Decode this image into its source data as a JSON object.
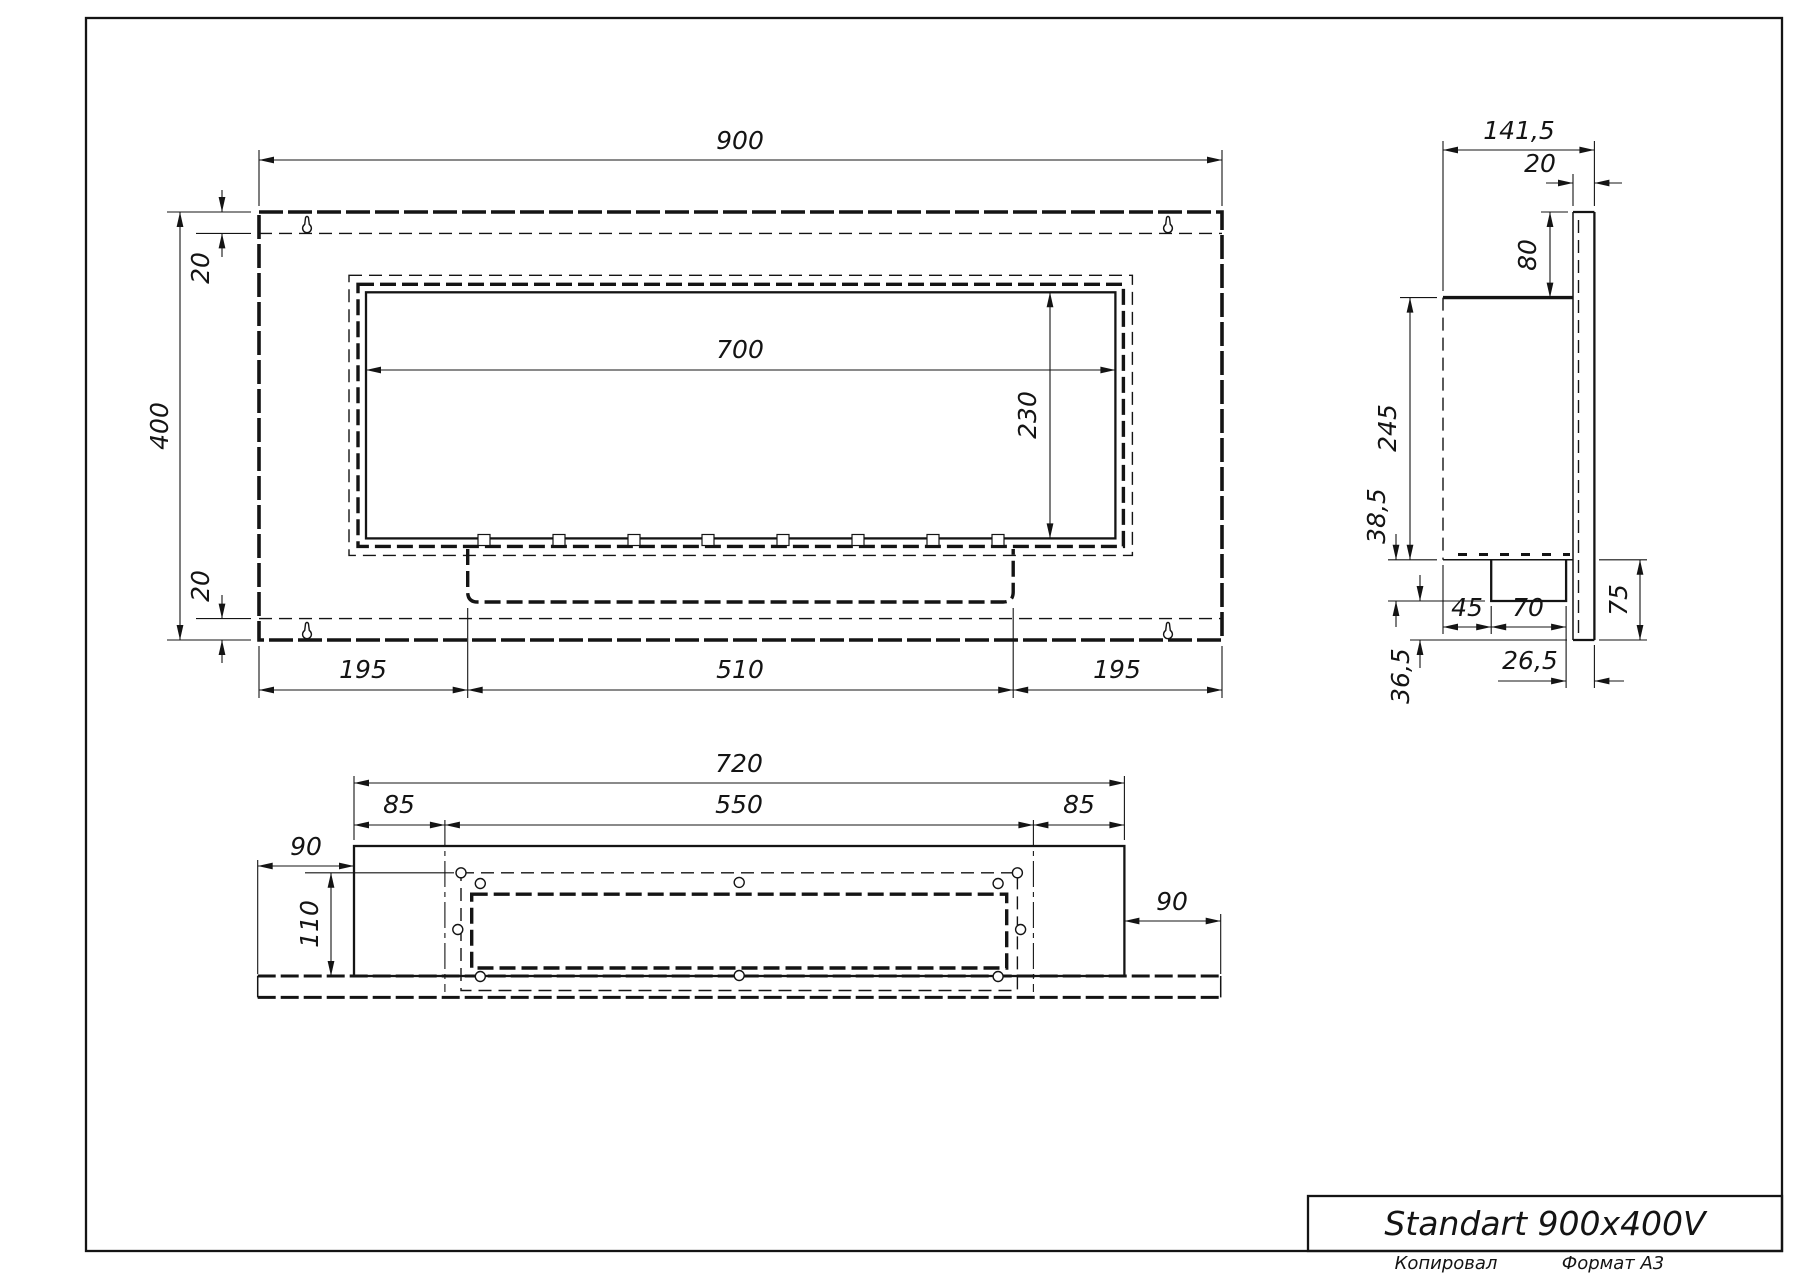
{
  "front_view": {
    "width": "900",
    "height": "400",
    "top_offset": "20",
    "bottom_offset": "20",
    "opening_width": "700",
    "opening_height": "230",
    "bottom_left": "195",
    "bottom_center": "510",
    "bottom_right": "195"
  },
  "side_view": {
    "depth": "141,5",
    "panel_thickness": "20",
    "top_drop": "80",
    "body_height": "245",
    "tray_depth": "38,5",
    "tray_front_offset": "45",
    "tray_width": "70",
    "panel_below_body": "75",
    "tray_back_gap": "26,5",
    "bottom_gap": "36,5"
  },
  "bottom_view": {
    "width": "720",
    "left_inset": "85",
    "cutout_width": "550",
    "right_inset": "85",
    "plate_left_overhang": "90",
    "cutout_depth": "110",
    "plate_right_overhang": "90"
  },
  "title_block": {
    "title": "Standart 900x400V",
    "copied_label": "Копировал",
    "format_label": "Формат А3"
  }
}
